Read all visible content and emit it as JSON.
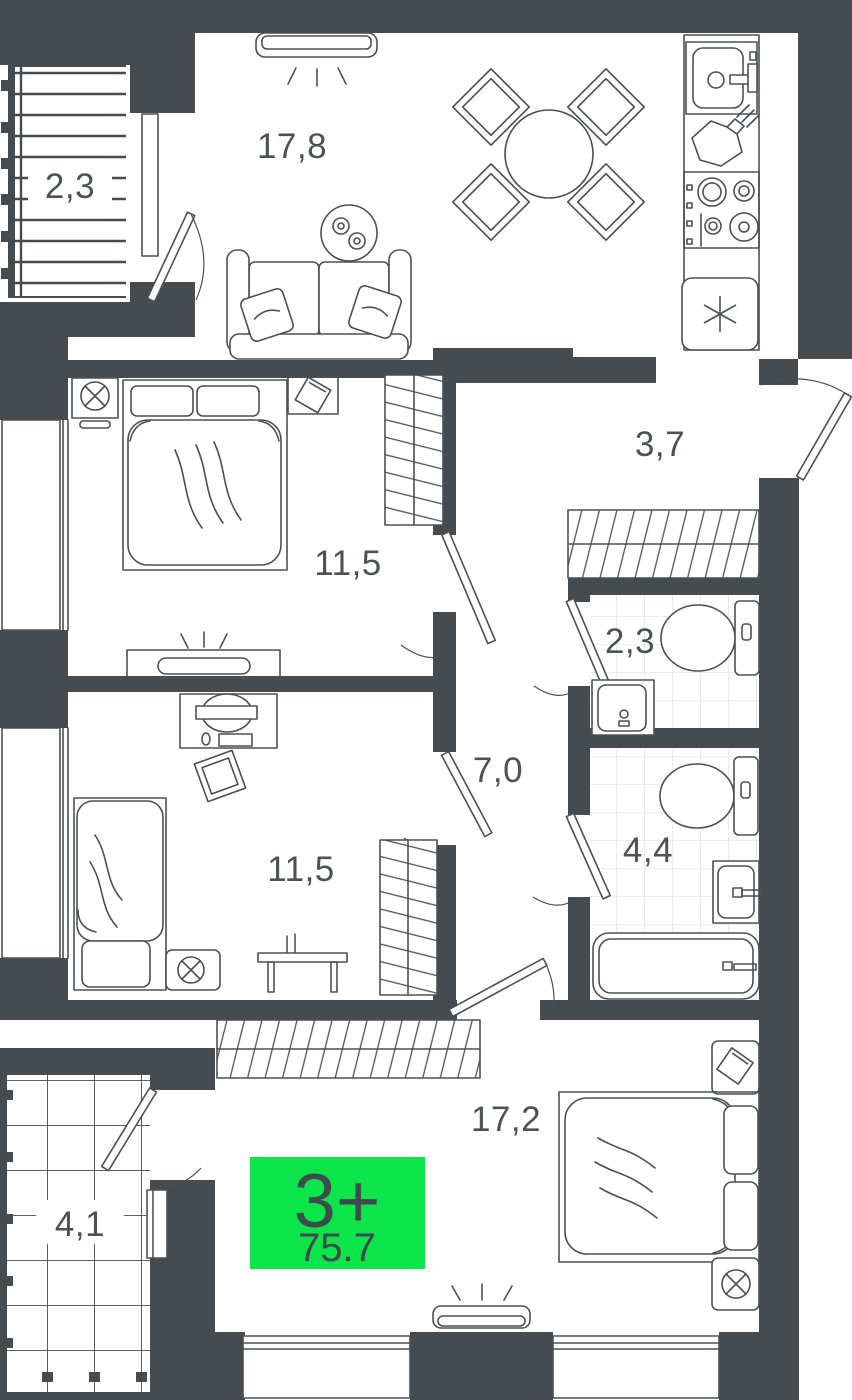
{
  "plan": {
    "type_badge": {
      "rooms_label": "3+",
      "area_label": "75.7"
    },
    "rooms": [
      {
        "id": "balcony-top",
        "area": "2,3"
      },
      {
        "id": "living-room",
        "area": "17,8"
      },
      {
        "id": "hallway",
        "area": "3,7"
      },
      {
        "id": "bedroom-1",
        "area": "11,5"
      },
      {
        "id": "wc",
        "area": "2,3"
      },
      {
        "id": "corridor",
        "area": "7,0"
      },
      {
        "id": "bathroom",
        "area": "4,4"
      },
      {
        "id": "bedroom-2",
        "area": "11,5"
      },
      {
        "id": "bedroom-3",
        "area": "17,2"
      },
      {
        "id": "balcony-bottom",
        "area": "4,1"
      }
    ],
    "colors": {
      "wall": "#454b4e",
      "furniture_line": "#4a5153",
      "badge_bg": "#0be549",
      "badge_text": "#3e4a4c",
      "label_text": "#4a5254",
      "tile_line": "#e4e8e8"
    }
  }
}
